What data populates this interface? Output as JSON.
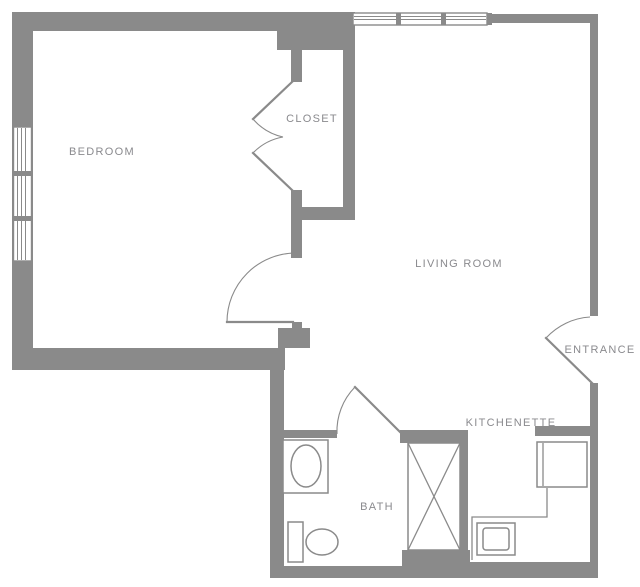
{
  "colors": {
    "wall": "#8A8A8A",
    "line": "#8A8A8A",
    "text": "#8A8A8E",
    "background": "#FFFFFF"
  },
  "rooms": {
    "bedroom": {
      "label": "BEDROOM"
    },
    "closet": {
      "label": "CLOSET"
    },
    "living_room": {
      "label": "LIVING ROOM"
    },
    "entrance": {
      "label": "ENTRANCE"
    },
    "bath": {
      "label": "BATH"
    },
    "kitchenette": {
      "label": "KITCHENETTE"
    }
  }
}
